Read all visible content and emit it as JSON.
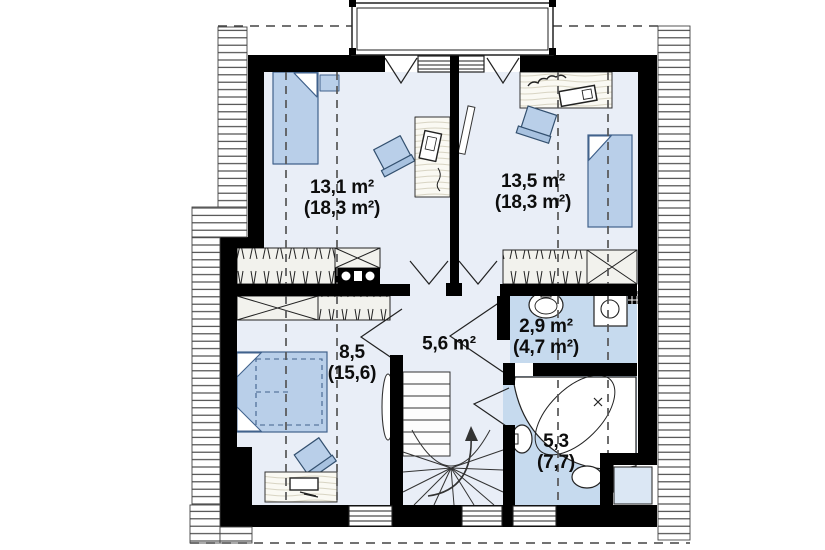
{
  "plan": {
    "title": "attic-floor-plan",
    "rooms": [
      {
        "id": "bedroom-top-left",
        "area": "13,1 m²",
        "total": "(18,3 m²)"
      },
      {
        "id": "bedroom-top-right",
        "area": "13,5 m²",
        "total": "(18,3 m²)"
      },
      {
        "id": "bedroom-bottom-left",
        "area": "8,5",
        "total": "(15,6)"
      },
      {
        "id": "hallway",
        "area": "5,6 m²"
      },
      {
        "id": "bathroom-upper",
        "area": "2,9 m²",
        "total": "(4,7 m²)"
      },
      {
        "id": "bathroom-lower",
        "area": "5,3",
        "total": "(7,7)"
      }
    ],
    "colors": {
      "wall": "#000000",
      "room_floor": "#e9eef7",
      "bath_floor": "#c6daee",
      "furniture_fill": "#b9cfe9",
      "wardrobe_fill": "#f2f2ed",
      "background": "#ffffff"
    },
    "icons": [
      "bed-icon",
      "double-bed-icon",
      "desk-icon",
      "chair-icon",
      "wardrobe-icon",
      "stairs-icon",
      "bathtub-icon",
      "toilet-icon",
      "sink-icon",
      "washing-machine-icon",
      "radiator-icon",
      "dormer-icon",
      "vent-icon",
      "cabinet-icon"
    ]
  }
}
